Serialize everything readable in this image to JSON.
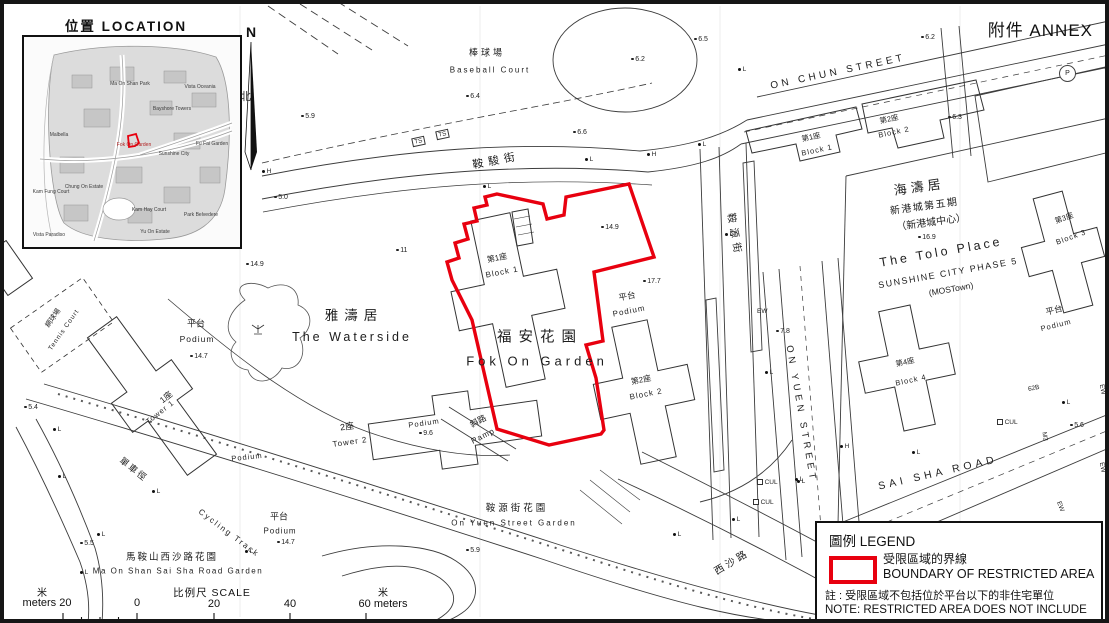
{
  "annex_label": "附件 ANNEX",
  "location": {
    "title": "位置 LOCATION",
    "labels": [
      {
        "t": "Ma On Shan Park",
        "x": 106,
        "y": 47
      },
      {
        "t": "Vista Oceania",
        "x": 176,
        "y": 50
      },
      {
        "t": "Bayshore Towers",
        "x": 148,
        "y": 72
      },
      {
        "t": "Malbella",
        "x": 35,
        "y": 98
      },
      {
        "t": "Fok On Garden",
        "x": 110,
        "y": 108,
        "c": "#b22222"
      },
      {
        "t": "Sunshine City",
        "x": 150,
        "y": 117
      },
      {
        "t": "Fu Fai Garden",
        "x": 188,
        "y": 107
      },
      {
        "t": "Kam Fung Court",
        "x": 27,
        "y": 155
      },
      {
        "t": "Chung On Estate",
        "x": 60,
        "y": 150
      },
      {
        "t": "Kam Hay Court",
        "x": 125,
        "y": 173
      },
      {
        "t": "Park Belvedere",
        "x": 177,
        "y": 178
      },
      {
        "t": "Vista Paradiso",
        "x": 25,
        "y": 198
      },
      {
        "t": "Yu On Estate",
        "x": 131,
        "y": 195
      }
    ]
  },
  "north": {
    "n": "N",
    "zh": "北"
  },
  "map_labels": [
    {
      "name": "baseball-court-zh",
      "t": "棒球場",
      "x": 487,
      "y": 52,
      "s": 9,
      "sp": 3
    },
    {
      "name": "baseball-court-en",
      "t": "Baseball Court",
      "x": 490,
      "y": 70,
      "s": 8,
      "sp": 2
    },
    {
      "name": "on-chun-street-label",
      "t": "ON CHUN STREET",
      "x": 838,
      "y": 72,
      "s": 10,
      "sp": 3.5,
      "r": -12
    },
    {
      "name": "on-chun-street-zh",
      "t": "鞍駿街",
      "x": 496,
      "y": 160,
      "s": 11,
      "sp": 5,
      "r": -11
    },
    {
      "name": "fok-on-garden-zh",
      "t": "福安花園",
      "x": 540,
      "y": 336,
      "s": 14.5,
      "sp": 7
    },
    {
      "name": "fok-on-garden-en",
      "t": "Fok On Garden",
      "x": 537,
      "y": 361,
      "s": 13,
      "sp": 4
    },
    {
      "name": "fog-block1-zh",
      "t": "第1座",
      "x": 497,
      "y": 258,
      "s": 8,
      "r": -11
    },
    {
      "name": "fog-block1-en",
      "t": "Block 1",
      "x": 502,
      "y": 272,
      "s": 8,
      "r": -11,
      "sp": 1
    },
    {
      "name": "fog-block2-zh",
      "t": "第2座",
      "x": 641,
      "y": 380,
      "s": 8,
      "r": -11
    },
    {
      "name": "fog-block2-en",
      "t": "Block 2",
      "x": 646,
      "y": 394,
      "s": 8,
      "r": -11,
      "sp": 1
    },
    {
      "name": "podium-east-zh",
      "t": "平台",
      "x": 627,
      "y": 296,
      "s": 8.5,
      "r": -11
    },
    {
      "name": "podium-east-en",
      "t": "Podium",
      "x": 629,
      "y": 311,
      "s": 8,
      "r": -11,
      "sp": 1
    },
    {
      "name": "waterside-zh",
      "t": "雅濤居",
      "x": 354,
      "y": 314,
      "s": 13.5,
      "sp": 6
    },
    {
      "name": "waterside-en",
      "t": "The Waterside",
      "x": 352,
      "y": 337,
      "s": 12.5,
      "sp": 3
    },
    {
      "name": "podium-west-zh",
      "t": "平台",
      "x": 196,
      "y": 323,
      "s": 9
    },
    {
      "name": "podium-west-en",
      "t": "Podium",
      "x": 197,
      "y": 339,
      "s": 8.5,
      "sp": 1
    },
    {
      "name": "ws-tower1-zh",
      "t": "1座",
      "x": 166,
      "y": 397,
      "s": 8.5,
      "r": -38
    },
    {
      "name": "ws-tower1-en",
      "t": "Tower 1",
      "x": 160,
      "y": 412,
      "s": 7.5,
      "r": -38,
      "sp": 1
    },
    {
      "name": "ws-tower2-zh",
      "t": "2座",
      "x": 347,
      "y": 426,
      "s": 9,
      "r": -8
    },
    {
      "name": "ws-tower2-en",
      "t": "Tower 2",
      "x": 350,
      "y": 442,
      "s": 8,
      "r": -8,
      "sp": 1
    },
    {
      "name": "ws-podium-mid",
      "t": "Podium",
      "x": 247,
      "y": 457,
      "s": 7.5,
      "r": -6,
      "sp": 1
    },
    {
      "name": "ws-podium-t2",
      "t": "Podium",
      "x": 424,
      "y": 423,
      "s": 7.5,
      "r": -8,
      "sp": 1
    },
    {
      "name": "tennis-court-zh",
      "t": "網球場",
      "x": 53,
      "y": 318,
      "s": 7,
      "r": -55
    },
    {
      "name": "tennis-court-en",
      "t": "Tennis Court",
      "x": 64,
      "y": 330,
      "s": 6.5,
      "r": -55,
      "sp": 1
    },
    {
      "name": "ramp-zh",
      "t": "斜路",
      "x": 478,
      "y": 421,
      "s": 8.5,
      "r": -27
    },
    {
      "name": "ramp-en",
      "t": "Ramp",
      "x": 483,
      "y": 436,
      "s": 8,
      "r": -27,
      "sp": 1
    },
    {
      "name": "on-yuen-garden-zh",
      "t": "鞍源街花園",
      "x": 517,
      "y": 507,
      "s": 9.5,
      "sp": 3
    },
    {
      "name": "on-yuen-garden-en",
      "t": "On Yuen Street Garden",
      "x": 514,
      "y": 523,
      "s": 8,
      "sp": 2
    },
    {
      "name": "cycling-track-zh",
      "t": "單車徑",
      "x": 134,
      "y": 469,
      "s": 9,
      "r": 38,
      "sp": 2
    },
    {
      "name": "cycling-track-en",
      "t": "Cycling Track",
      "x": 229,
      "y": 533,
      "s": 8,
      "r": 37,
      "sp": 2
    },
    {
      "name": "mosssr-garden-zh",
      "t": "馬鞍山西沙路花園",
      "x": 172,
      "y": 556,
      "s": 9.5,
      "sp": 2
    },
    {
      "name": "mosssr-garden-en",
      "t": "Ma On Shan Sai Sha Road Garden",
      "x": 178,
      "y": 571,
      "s": 8,
      "sp": 1.5
    },
    {
      "name": "on-yuen-street-label",
      "t": "ON YUEN STREET",
      "x": 801,
      "y": 414,
      "s": 9.5,
      "sp": 4,
      "r": 80
    },
    {
      "name": "on-yuen-street-zh",
      "t": "鞍源街",
      "x": 736,
      "y": 235,
      "s": 10,
      "sp": 5,
      "r": 80
    },
    {
      "name": "sai-sha-road-label",
      "t": "SAI SHA ROAD",
      "x": 938,
      "y": 473,
      "s": 10.5,
      "sp": 4,
      "r": -13
    },
    {
      "name": "sai-sha-road-zh",
      "t": "西沙路",
      "x": 731,
      "y": 561,
      "s": 10,
      "sp": 3,
      "r": -31
    },
    {
      "name": "tolo-place-zh",
      "t": "海濤居",
      "x": 919,
      "y": 186,
      "s": 13,
      "sp": 4,
      "r": -8
    },
    {
      "name": "tolo-phase-zh",
      "t": "新港城第五期",
      "x": 924,
      "y": 205,
      "s": 10,
      "sp": 1.5,
      "r": -8
    },
    {
      "name": "tolo-centre-zh",
      "t": "（新港城中心）",
      "x": 931,
      "y": 221,
      "s": 10,
      "r": -8
    },
    {
      "name": "tolo-place-en",
      "t": "The Tolo Place",
      "x": 941,
      "y": 252,
      "s": 12.5,
      "sp": 3,
      "r": -10
    },
    {
      "name": "tolo-phase-en",
      "t": "SUNSHINE CITY PHASE 5",
      "x": 948,
      "y": 273,
      "s": 9,
      "sp": 1.5,
      "r": -10
    },
    {
      "name": "tolo-mostown-en",
      "t": "(MOSTown)",
      "x": 951,
      "y": 289,
      "s": 8.5,
      "r": -10
    },
    {
      "name": "tp-block1-zh",
      "t": "第1座",
      "x": 811,
      "y": 137,
      "s": 7.5,
      "r": -12
    },
    {
      "name": "tp-block1-en",
      "t": "Block 1",
      "x": 817,
      "y": 150,
      "s": 7.5,
      "r": -12,
      "sp": 1
    },
    {
      "name": "tp-block2-zh",
      "t": "第2座",
      "x": 889,
      "y": 119,
      "s": 7.5,
      "r": -12
    },
    {
      "name": "tp-block2-en",
      "t": "Block 2",
      "x": 894,
      "y": 132,
      "s": 7.5,
      "r": -12,
      "sp": 1
    },
    {
      "name": "tp-block3-zh",
      "t": "第3座",
      "x": 1064,
      "y": 218,
      "s": 7.5,
      "r": -20
    },
    {
      "name": "tp-block3-en",
      "t": "Block 3",
      "x": 1071,
      "y": 237,
      "s": 7.5,
      "r": -20,
      "sp": 1
    },
    {
      "name": "tp-block4-zh",
      "t": "第4座",
      "x": 905,
      "y": 362,
      "s": 7.5,
      "r": -12
    },
    {
      "name": "tp-block4-en",
      "t": "Block 4",
      "x": 911,
      "y": 380,
      "s": 7.5,
      "r": -12,
      "sp": 1
    },
    {
      "name": "tp-podium-zh",
      "t": "平台",
      "x": 1054,
      "y": 310,
      "s": 8.5,
      "r": -14
    },
    {
      "name": "tp-podium-en",
      "t": "Podium",
      "x": 1056,
      "y": 325,
      "s": 7.5,
      "r": -14,
      "sp": 1
    },
    {
      "name": "podium-sw-zh",
      "t": "平台",
      "x": 279,
      "y": 516,
      "s": 9
    },
    {
      "name": "podium-sw-en",
      "t": "Podium",
      "x": 280,
      "y": 531,
      "s": 8,
      "sp": 1
    }
  ],
  "spot_heights": [
    {
      "v": "6.4",
      "x": 466,
      "y": 97
    },
    {
      "v": "5.9",
      "x": 301,
      "y": 117
    },
    {
      "v": "5.0",
      "x": 274,
      "y": 198
    },
    {
      "v": "6.5",
      "x": 694,
      "y": 40
    },
    {
      "v": "6.2",
      "x": 921,
      "y": 38
    },
    {
      "v": "6.2",
      "x": 631,
      "y": 60
    },
    {
      "v": "6.3",
      "x": 948,
      "y": 118
    },
    {
      "v": "6.6",
      "x": 573,
      "y": 133
    },
    {
      "v": "14.9",
      "x": 601,
      "y": 228
    },
    {
      "v": "17.7",
      "x": 643,
      "y": 282
    },
    {
      "v": "14.9",
      "x": 246,
      "y": 265
    },
    {
      "v": "14.7",
      "x": 190,
      "y": 357
    },
    {
      "v": "14.7",
      "x": 277,
      "y": 543
    },
    {
      "v": "9.6",
      "x": 419,
      "y": 434
    },
    {
      "v": "7.8",
      "x": 776,
      "y": 332
    },
    {
      "v": "5.9",
      "x": 466,
      "y": 551
    },
    {
      "v": "5.6",
      "x": 1070,
      "y": 426
    },
    {
      "v": "5.5",
      "x": 80,
      "y": 544
    },
    {
      "v": "5.4",
      "x": 24,
      "y": 408
    },
    {
      "v": "11",
      "x": 396,
      "y": 251
    },
    {
      "v": "16.9",
      "x": 918,
      "y": 238
    }
  ],
  "markers": [
    {
      "t": "L",
      "k": "dot",
      "x": 738,
      "y": 70
    },
    {
      "t": "L",
      "k": "dot",
      "x": 698,
      "y": 145
    },
    {
      "t": "L",
      "k": "dot",
      "x": 585,
      "y": 160
    },
    {
      "t": "L",
      "k": "dot",
      "x": 483,
      "y": 187
    },
    {
      "t": "L",
      "k": "dot",
      "x": 725,
      "y": 235
    },
    {
      "t": "L",
      "k": "dot",
      "x": 765,
      "y": 373
    },
    {
      "t": "L",
      "k": "dot",
      "x": 797,
      "y": 482
    },
    {
      "t": "L",
      "k": "dot",
      "x": 1062,
      "y": 403
    },
    {
      "t": "L",
      "k": "dot",
      "x": 912,
      "y": 453
    },
    {
      "t": "L",
      "k": "dot",
      "x": 673,
      "y": 535
    },
    {
      "t": "L",
      "k": "dot",
      "x": 732,
      "y": 520
    },
    {
      "t": "L",
      "k": "dot",
      "x": 795,
      "y": 480
    },
    {
      "t": "L",
      "k": "dot",
      "x": 53,
      "y": 430
    },
    {
      "t": "L",
      "k": "dot",
      "x": 58,
      "y": 477
    },
    {
      "t": "L",
      "k": "dot",
      "x": 97,
      "y": 535
    },
    {
      "t": "L",
      "k": "dot",
      "x": 80,
      "y": 573
    },
    {
      "t": "L",
      "k": "dot",
      "x": 152,
      "y": 492
    },
    {
      "t": "L",
      "k": "dot",
      "x": 245,
      "y": 552
    },
    {
      "t": "H",
      "k": "dot",
      "x": 262,
      "y": 172
    },
    {
      "t": "H",
      "k": "dot",
      "x": 647,
      "y": 155
    },
    {
      "t": "H",
      "k": "dot",
      "x": 840,
      "y": 447
    },
    {
      "t": "TS",
      "k": "box",
      "x": 412,
      "y": 141,
      "r": -12
    },
    {
      "t": "TS",
      "k": "box",
      "x": 436,
      "y": 134,
      "r": -12
    },
    {
      "t": "P",
      "k": "circle",
      "x": 1059,
      "y": 69
    },
    {
      "t": "EW",
      "k": "txt",
      "x": 757,
      "y": 312
    },
    {
      "t": "EW",
      "k": "txt",
      "x": 1097,
      "y": 390,
      "r": 80
    },
    {
      "t": "EW",
      "k": "txt",
      "x": 1097,
      "y": 468,
      "r": 80
    },
    {
      "t": "EW",
      "k": "txt",
      "x": 1055,
      "y": 507,
      "r": 70
    },
    {
      "t": "CUL",
      "k": "sq",
      "x": 997,
      "y": 423
    },
    {
      "t": "CUL",
      "k": "sq",
      "x": 757,
      "y": 483
    },
    {
      "t": "CUL",
      "k": "sq",
      "x": 753,
      "y": 503
    },
    {
      "t": "M3",
      "k": "txt",
      "x": 1040,
      "y": 437,
      "r": 80
    },
    {
      "t": "62B",
      "k": "txt",
      "x": 1028,
      "y": 389,
      "r": -12
    }
  ],
  "legend": {
    "title": "圖例 LEGEND",
    "boundary_zh": "受限區域的界線",
    "boundary_en": "BOUNDARY OF RESTRICTED AREA",
    "note_zh": "註 : 受限區域不包括位於平台以下的非住宅單位",
    "note_en_1": "NOTE: RESTRICTED AREA DOES NOT INCLUDE",
    "note_en_2": "NON-DOMESTIC UNITS UNDER THE PODIUM"
  },
  "scale": {
    "title": "比例尺  SCALE",
    "zh_left": "米",
    "left_label": "meters 20",
    "t0": "0",
    "t20": "20",
    "t40": "40",
    "right_label": "60 meters",
    "zh_right": "米"
  },
  "colors": {
    "boundary_red": "#e8000f",
    "line": "#3c3c3c"
  }
}
